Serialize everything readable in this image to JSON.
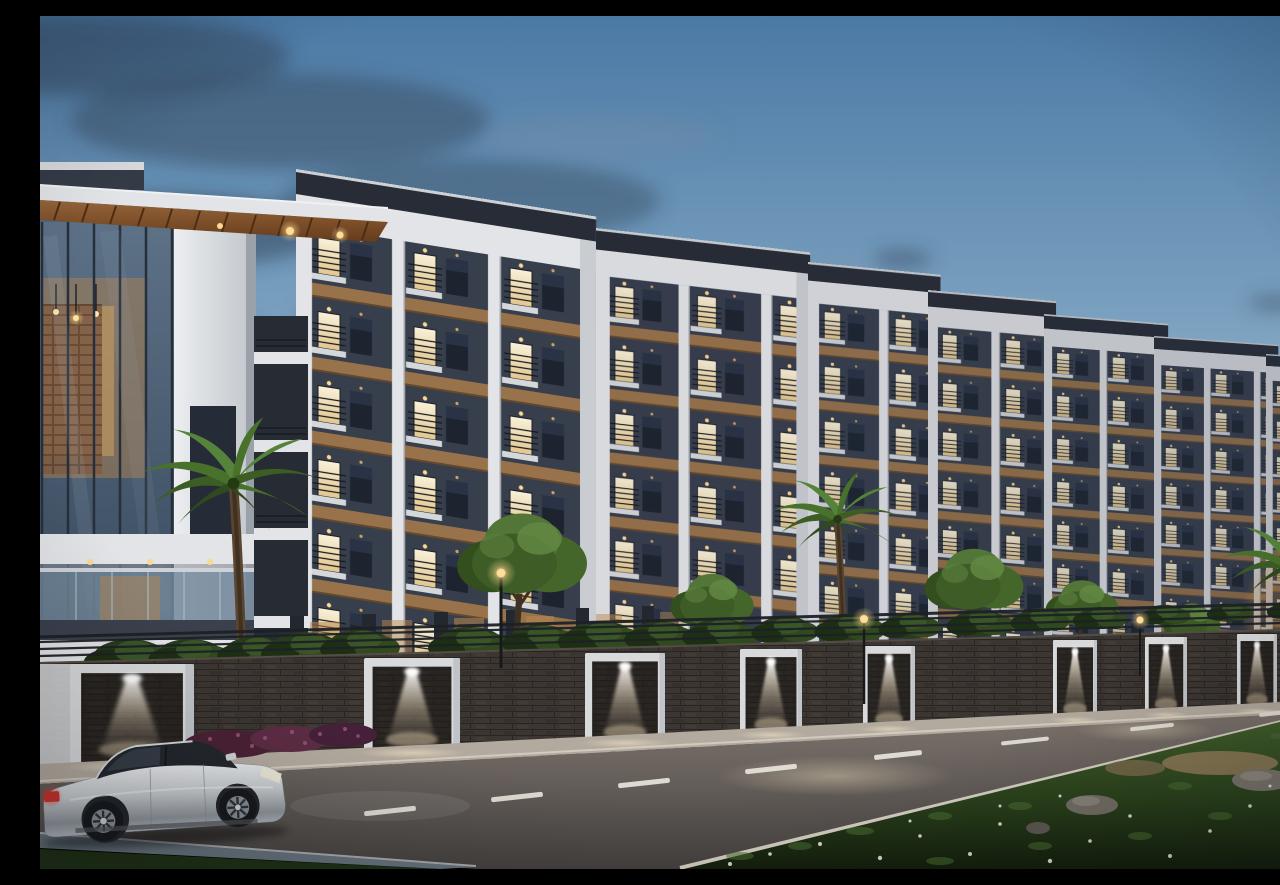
{
  "scene": {
    "type": "3d-architectural-render",
    "setting": "modern gated apartment complex at dusk",
    "time_of_day": "dusk",
    "description": "Evening exterior rendering of a residential community: a receding row of five-to-six storey apartment blocks with white structural frames, dark charcoal infill walls, timber-brown accent bands and warmly lit windows; a glass-fronted clubhouse with a timber-soffit cantilever roof on the left; a dark stone compound wall with white-framed gate piers washed by V-shaped downlights; palm and broadleaf trees with shrubs; a lamp-lit asphalt road with dashed lane markings in front; a silver fastback sedan driving past; a grass verge with wildflowers, rocks and a sandy patch in the lower right.",
    "elements": [
      "sky",
      "clouds",
      "apartment-blocks",
      "clubhouse",
      "balcony-slab-stack",
      "stilt-parking-lights",
      "shrubs",
      "palm-trees",
      "green-trees",
      "compound-wall",
      "wall-railing",
      "gate-piers",
      "gate-downlights",
      "street-lamps",
      "sidewalk",
      "flower-hedge",
      "road",
      "lane-markings",
      "curb",
      "grass-verge",
      "rocks",
      "sand-patch",
      "wildflowers",
      "silver-sedan"
    ]
  },
  "counts": {
    "apartment_blocks": 7,
    "gate_piers": 8,
    "palm_trees": 3,
    "green_trees": 5,
    "street_lamps": 3,
    "cars": 1
  },
  "palette": {
    "sky_top": "#4b79a5",
    "sky_mid": "#87abc6",
    "sky_horizon": "#c4d9e6",
    "cloud_dark": "#36495f",
    "building_white": "#e2e4e7",
    "building_dark": "#373e4c",
    "roof_dark": "#272c36",
    "window_warm": "#f4e9c8",
    "window_dark": "#1d2430",
    "accent_brown": "#97724a",
    "wood_soffit": "#8a5a2e",
    "glass_blue": "#53677d",
    "wall_stone": "#3b3632",
    "gate_white": "#d8d9db",
    "light_warm": "#ffd88f",
    "foliage_green": "#3d5c26",
    "palm_green": "#4e7a30",
    "road_gray": "#6e6560",
    "sidewalk_tan": "#b3aa9f",
    "lane_white": "#e8e5dc",
    "grass_green": "#2f4a20",
    "rock_gray": "#736e65",
    "sand_tan": "#8d7a58",
    "car_silver": "#c6cacd",
    "taillight_red": "#c23028",
    "tire_black": "#17191c"
  }
}
